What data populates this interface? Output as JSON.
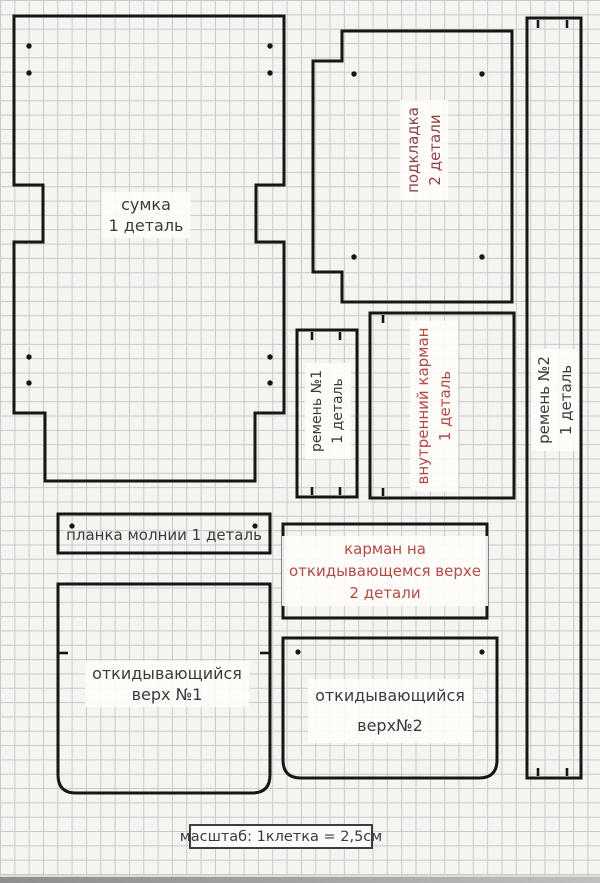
{
  "colors": {
    "paper": "#f5f4f1",
    "grid": "#c9c9c9",
    "outline": "#161616",
    "text_dark": "#3b3b3b",
    "text_red": "#b24a45",
    "text_maroon": "#8e4347"
  },
  "pieces": {
    "bag": {
      "line1": "сумка",
      "line2": "1 деталь"
    },
    "lining": {
      "line1": "подкладка",
      "line2": "2 детали"
    },
    "strap1": {
      "line1": "ремень №1",
      "line2": "1 деталь"
    },
    "strap2": {
      "line1": "ремень №2",
      "line2": "1 деталь"
    },
    "inner_pocket": {
      "line1": "внутренний карман",
      "line2": "1 деталь"
    },
    "zipper_placket": {
      "line1": "планка молнии 1 деталь"
    },
    "flap_pocket": {
      "line1": "карман на",
      "line2": "откидывающемся верхе",
      "line3": "2 детали"
    },
    "flip_top_1": {
      "line1": "откидывающийся",
      "line2": "верх №1"
    },
    "flip_top_2": {
      "line1": "откидывающийся",
      "line2": "верх№2"
    }
  },
  "scale_note": "масштаб: 1клетка = 2,5см"
}
